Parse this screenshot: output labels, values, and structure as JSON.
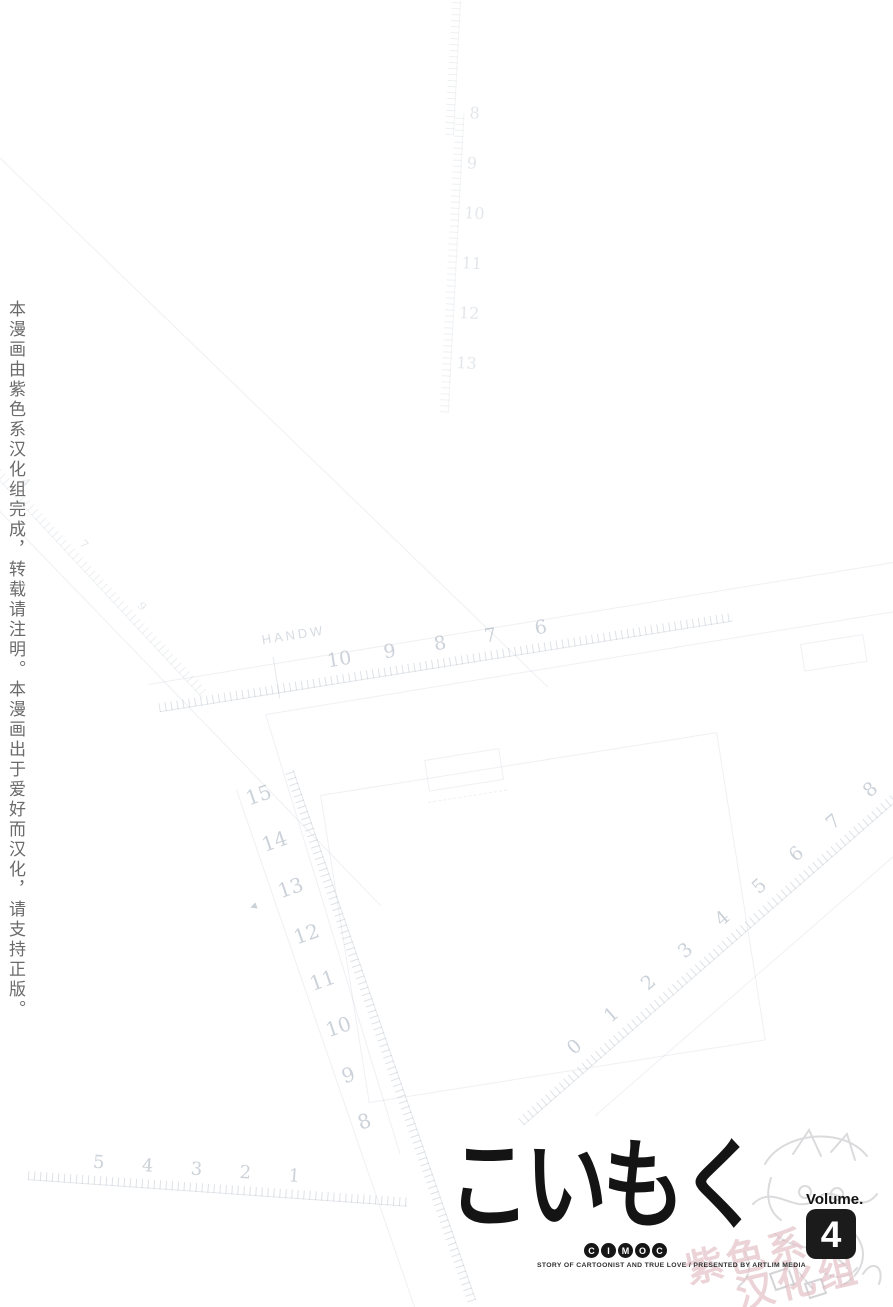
{
  "side_note": {
    "text": "本漫画由紫色系汉化组完成，转载请注明。本漫画出于爱好而汉化，请支持正版。"
  },
  "logo": {
    "title": "こいもく",
    "subtitle_letters": [
      "C",
      "I",
      "M",
      "O",
      "C"
    ],
    "tagline": "STORY OF CARTOONIST AND TRUE LOVE / PRESENTED BY ARTLIM MEDIA",
    "volume_label": "Volume.",
    "volume_number": "4"
  },
  "watermark": {
    "lines": [
      "紫色系",
      "汉化组"
    ]
  },
  "background_rulers": {
    "handw": {
      "label": "HANDW",
      "numbers": [
        "10",
        "9",
        "8",
        "7",
        "6"
      ]
    },
    "left_vertical": {
      "numbers": [
        "15",
        "14",
        "13",
        "12",
        "11",
        "10",
        "9",
        "8"
      ],
      "arrow": "◄"
    },
    "diagonal_right": {
      "numbers": [
        "0",
        "1",
        "2",
        "3",
        "4",
        "5",
        "6",
        "7",
        "8"
      ]
    },
    "bottom_left": {
      "numbers": [
        "5",
        "4",
        "3",
        "2",
        "1"
      ]
    },
    "top_vertical": {
      "numbers": [
        "8",
        "9",
        "10",
        "11",
        "12",
        "13"
      ]
    },
    "top_left_mini": {
      "numbers": [
        "4",
        "7",
        "9"
      ]
    }
  },
  "colors": {
    "ink": "#141414",
    "badge_bg": "#1b1b1b",
    "badge_text": "#ffffff",
    "side_note_text": "#6b6b6b",
    "watermark_pink": "#d5a4ac",
    "ruler_line": "#e3e7eb",
    "ruler_number": "#dde2e8"
  }
}
